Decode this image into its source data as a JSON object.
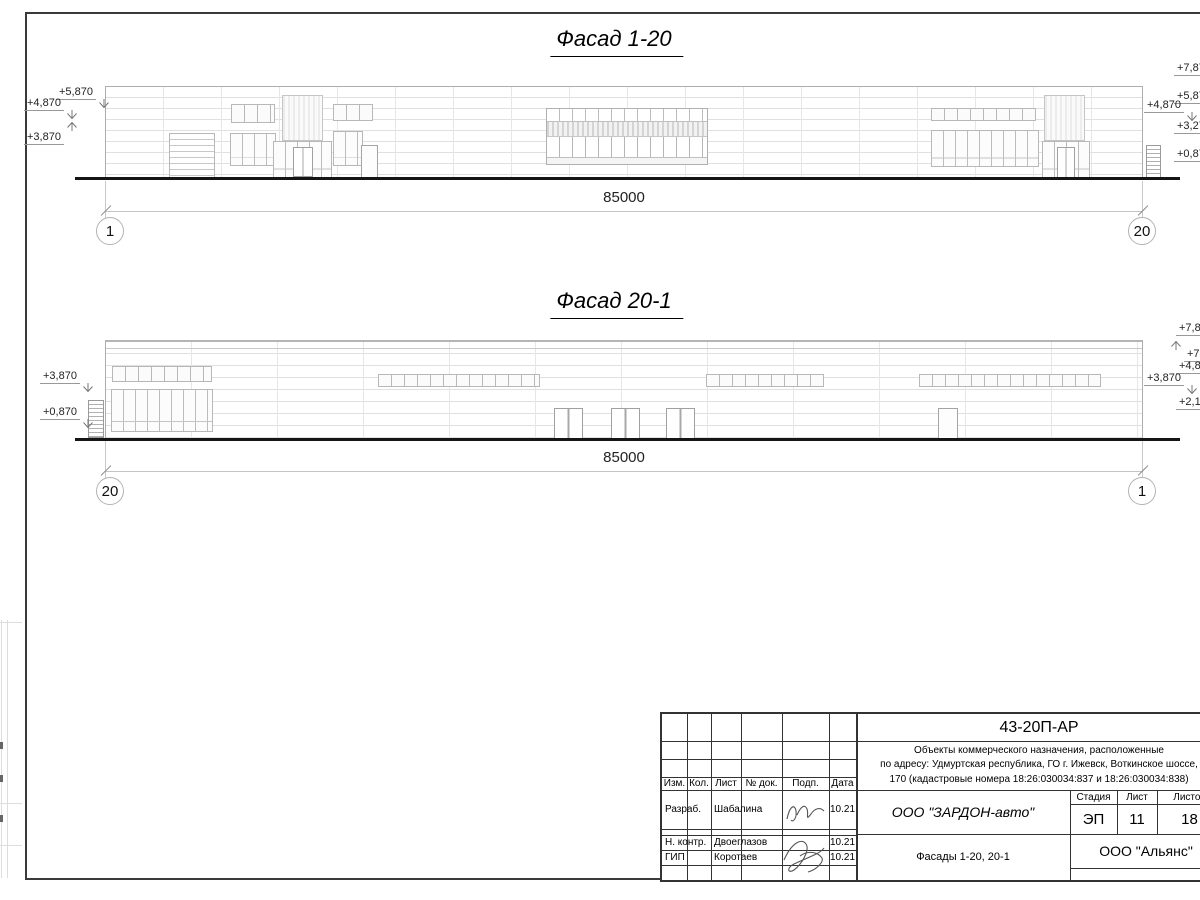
{
  "facade1": {
    "title": "Фасад 1-20",
    "dimension": "85000",
    "axis_left": "1",
    "axis_right": "20",
    "marks_left": [
      "+5,870",
      "+4,870",
      "+3,870"
    ],
    "marks_right": [
      "+7,87",
      "+5,87",
      "+4,870",
      "+3,27",
      "+0,87"
    ]
  },
  "facade2": {
    "title": "Фасад 20-1",
    "dimension": "85000",
    "axis_left": "20",
    "axis_right": "1",
    "marks_left": [
      "+3,870",
      "+0,870"
    ],
    "marks_right": [
      "+7,8",
      "+7,",
      "+4,8",
      "+3,870",
      "+2,1"
    ]
  },
  "titleblock": {
    "code": "43-20П-АР",
    "description_lines": [
      "Объекты коммерческого назначения, расположенные",
      "по адресу: Удмуртская республика, ГО г. Ижевск, Воткинское шоссе,",
      "170 (кадастровые номера 18:26:030034:837 и 18:26:030034:838)"
    ],
    "columns": [
      "Изм.",
      "Кол.",
      "Лист",
      "№ док.",
      "Подп.",
      "Дата"
    ],
    "rows": [
      {
        "role": "Разраб.",
        "name": "Шабалина",
        "date": "10.21"
      },
      {
        "role": "Н. контр.",
        "name": "Двоеглазов",
        "date": "10.21"
      },
      {
        "role": "ГИП",
        "name": "Коротаев",
        "date": "10.21"
      }
    ],
    "company": "ООО \"ЗАРДОН-авто\"",
    "stage_label": "Стадия",
    "sheet_label": "Лист",
    "sheets_label": "Листов",
    "stage": "ЭП",
    "sheet": "11",
    "sheets": "18",
    "doc_title": "Фасады 1-20, 20-1",
    "contractor": "ООО \"Альянс\""
  }
}
